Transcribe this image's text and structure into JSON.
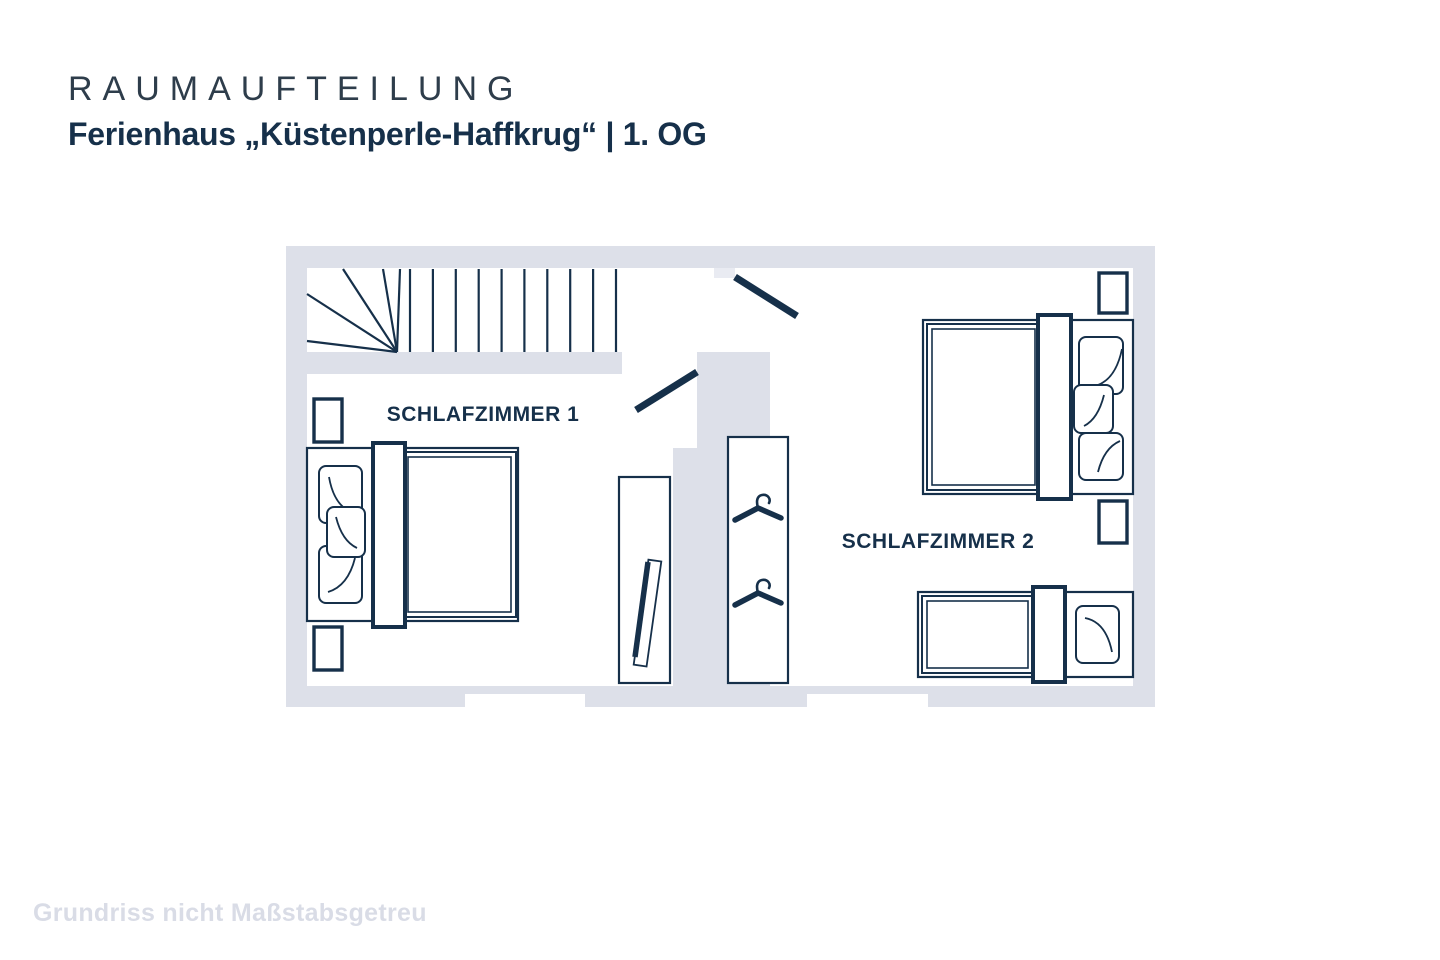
{
  "header": {
    "title": "RAUMAUFTEILUNG",
    "subtitle": "Ferienhaus „Küstenperle-Haffkrug“ | 1. OG"
  },
  "floorplan": {
    "rooms": [
      {
        "id": "schlafzimmer-1",
        "label": "SCHLAFZIMMER 1",
        "furniture": [
          "double-bed",
          "nightstand",
          "nightstand",
          "leaning-board-cabinet"
        ]
      },
      {
        "id": "schlafzimmer-2",
        "label": "SCHLAFZIMMER 2",
        "furniture": [
          "double-bed",
          "nightstand",
          "nightstand",
          "single-bed",
          "wardrobe-with-hangers"
        ]
      }
    ],
    "features": [
      "staircase",
      "door-swing",
      "door-swing",
      "window",
      "window",
      "hanger-icon",
      "hanger-icon"
    ]
  },
  "footer": {
    "disclaimer": "Grundriss nicht Maßstabsgetreu"
  },
  "colors": {
    "wall": "#dde0e9",
    "wall-light": "#e9ebf2",
    "line": "#16304a",
    "text-dark": "#16304a",
    "title": "#2e3d4b",
    "muted": "#d9dce6",
    "background": "#ffffff"
  }
}
